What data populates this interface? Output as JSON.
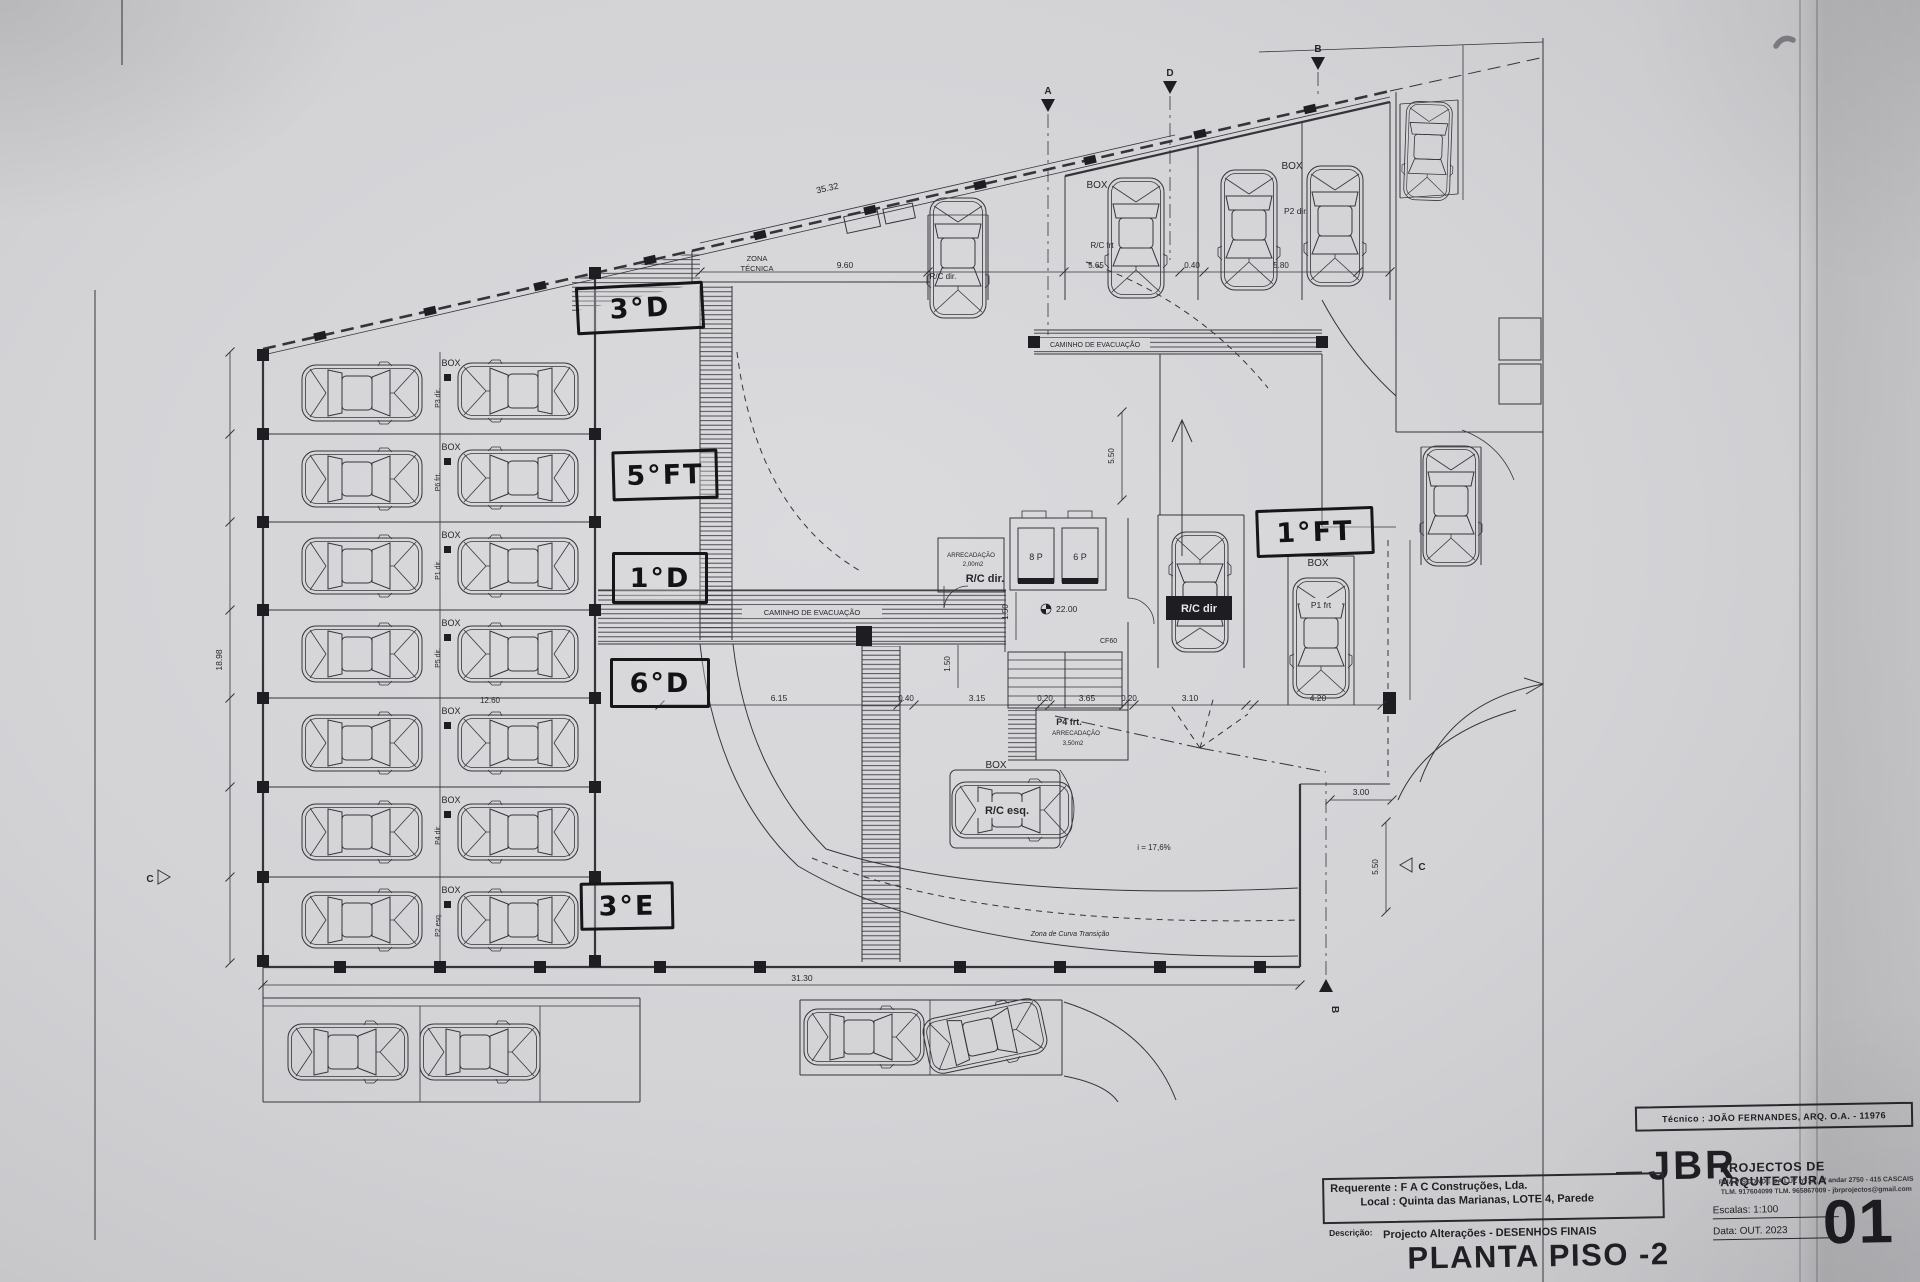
{
  "handwritten": {
    "l3d": "3°D",
    "l5ft": "5°FT",
    "l1d": "1°D",
    "l6d": "6°D",
    "l3e": "3°E",
    "l1ft": "1°FT"
  },
  "plan": {
    "zona_tecnica_1": "ZONA",
    "zona_tecnica_2": "TÉCNICA",
    "caminho": "CAMINHO DE EVACUAÇÃO",
    "arrec1_title": "ARRECADAÇÃO",
    "arrec1_area": "2,00m2",
    "arrec2_title": "ARRECADAÇÃO",
    "arrec2_area": "3,50m2",
    "rc_dir": "R/C dir.",
    "rc_dir_badge": "R/C dir",
    "rc_esq": "R/C esq.",
    "rc_frt": "R/C frt",
    "car_top_label": "R/C dir.",
    "p2_dir": "P2 dir.",
    "p1_frt": "P1 frt",
    "p4_frt": "P4 frt.",
    "elev_left": "8 P",
    "elev_right": "6 P",
    "level": "22.00",
    "cf": "CF60",
    "slope": "i = 17,6%",
    "curva": "Zona de Curva Transição",
    "box": "BOX",
    "stall_rows": [
      {
        "box": "BOX",
        "code": "P3 dir."
      },
      {
        "box": "BOX",
        "code": "P6 frt."
      },
      {
        "box": "BOX",
        "code": "P1 dir."
      },
      {
        "box": "BOX",
        "code": "P5 dir."
      },
      {
        "box": "BOX",
        "code": ""
      },
      {
        "box": "BOX",
        "code": "P4 dir."
      },
      {
        "box": "BOX",
        "code": "P2 esq."
      }
    ]
  },
  "dims": {
    "t35": "35.32",
    "t96": "9.60",
    "t565": "5.65",
    "t04": "0.40",
    "t58": "5.80",
    "m615": "6.15",
    "m04": "0.40",
    "m315": "3.15",
    "m02a": "0.20",
    "m365": "3.65",
    "m02b": "0.20",
    "m31": "3.10",
    "m42": "4.20",
    "b313": "31.30",
    "l1898": "18.98",
    "s126": "12.60",
    "r3": "3.00",
    "r55": "5.50",
    "v55": "5.50",
    "v15a": "1.50",
    "v15b": "1.50"
  },
  "sections": {
    "a": "A",
    "b": "B",
    "c": "C",
    "d": "D"
  },
  "title_block": {
    "tecnico": "Técnico : JOÃO FERNANDES, ARQ.   O.A. - 11976",
    "logo": "JBR",
    "logo_sub": "PROJECTOS DE ARQUITECTURA",
    "address1": "RUA VISCONDE DA LUZ nº 1A, 1º andar  2750 - 415  CASCAIS",
    "address2": "TLM. 917604099  TLM. 965867009 - jbrprojectos@gmail.com",
    "requerente": "Requerente : F A C  Construções, Lda.",
    "local": "Local : Quinta das Marianas, LOTE 4, Parede",
    "descricao_label": "Descrição:",
    "descricao": "Projecto Alterações - DESENHOS FINAIS",
    "drawing_title": "PLANTA PISO -2",
    "escala": "Escalas:  1:100",
    "data": "Data: OUT.  2023",
    "sheet": "01"
  }
}
